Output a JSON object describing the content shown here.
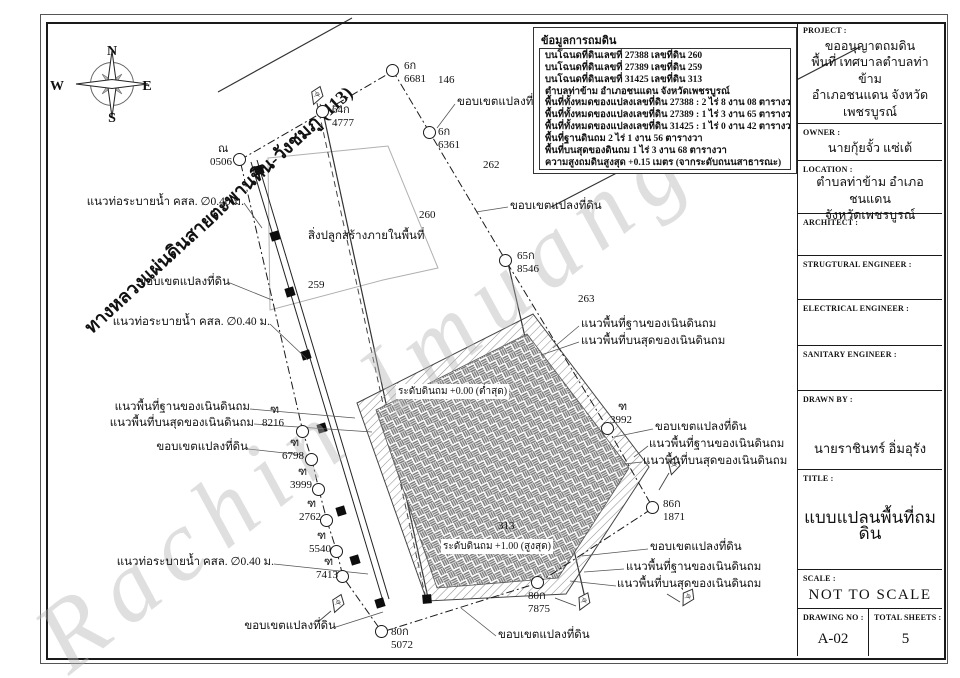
{
  "watermark": "Rachin Imuang",
  "compass": {
    "n": "N",
    "s": "S",
    "e": "E",
    "w": "W"
  },
  "road_label": "ทางหลวงแผ่นดินสายตะพานหิน-วังชมภู (113)",
  "info_box": {
    "title": "ข้อมูลการถมดิน",
    "lines": [
      "บนโฉนดที่ดินเลขที่ 27388 เลขที่ดิน 260",
      "บนโฉนดที่ดินเลขที่ 27389 เลขที่ดิน 259",
      "บนโฉนดที่ดินเลขที่ 31425 เลขที่ดิน 313",
      "ตำบลท่าข้าม อำเภอชนแดน จังหวัดเพชรบูรณ์",
      "พื้นที่ทั้งหมดของแปลงเลขที่ดิน 27388 : 2 ไร่ 8 งาน 08 ตารางวา",
      "พื้นที่ทั้งหมดของแปลงเลขที่ดิน 27389 : 1 ไร่ 3 งาน 65 ตารางวา",
      "พื้นที่ทั้งหมดของแปลงเลขที่ดิน 31425 : 1 ไร่ 0 งาน 42 ตารางวา",
      "พื้นที่ฐานดินถม 2 ไร่ 1 งาน 56 ตารางวา",
      "พื้นที่บนสุดของดินถม 1 ไร่ 3 งาน 68 ตารางวา",
      "ความสูงถมดินสูงสุด +0.15 เมตร (จากระดับถนนสาธารณะ)"
    ]
  },
  "title_block": {
    "project": {
      "label": "PROJECT :",
      "lines": [
        "ขออนุญาตถมดิน",
        "พื้นที่ เทศบาลตำบลท่าข้าม",
        "อำเภอชนแดน จังหวัดเพชรบูรณ์"
      ]
    },
    "owner": {
      "label": "OWNER :",
      "value": "นายกุ้ยจั้ว แซ่เต้"
    },
    "location": {
      "label": "LOCATION :",
      "lines": [
        "ตำบลท่าข้าม อำเภอชนแดน",
        "จังหวัดเพชรบูรณ์"
      ]
    },
    "architect": {
      "label": "ARCHITECT :",
      "value": ""
    },
    "structural": {
      "label": "STRUGTURAL ENGINEER :",
      "value": ""
    },
    "electrical": {
      "label": "ELECTRICAL ENGINEER :",
      "value": ""
    },
    "sanitary": {
      "label": "SANITARY ENGINEER :",
      "value": ""
    },
    "drawn_by": {
      "label": "DRAWN BY :",
      "value": "นายราชินทร์ อิ่มอุรัง"
    },
    "title": {
      "label": "TITLE :",
      "value": "แบบแปลนพื้นที่ถมดิน"
    },
    "scale": {
      "label": "SCALE :",
      "value": "NOT TO SCALE"
    },
    "drawing_no": {
      "label": "DRAWING NO :",
      "value": "A-02"
    },
    "total_sheets": {
      "label": "TOTAL SHEETS :",
      "value": "5"
    }
  },
  "plan": {
    "points": [
      {
        "name": "ณ",
        "num": "0506",
        "cx": 240,
        "cy": 160,
        "lx": 210,
        "ly": 143
      },
      {
        "name": "64ก",
        "num": "4777",
        "cx": 323,
        "cy": 112,
        "lx": 332,
        "ly": 104
      },
      {
        "name": "6ก",
        "num": "6681",
        "cx": 393,
        "cy": 71,
        "lx": 404,
        "ly": 60
      },
      {
        "name": "6ก",
        "num": "6361",
        "cx": 430,
        "cy": 133,
        "lx": 438,
        "ly": 126
      },
      {
        "name": "65ก",
        "num": "8546",
        "cx": 506,
        "cy": 261,
        "lx": 517,
        "ly": 250
      },
      {
        "name": "ฑ",
        "num": "3992",
        "cx": 608,
        "cy": 429,
        "lx": 610,
        "ly": 401
      },
      {
        "name": "86ก",
        "num": "1871",
        "cx": 653,
        "cy": 508,
        "lx": 663,
        "ly": 498
      },
      {
        "name": "80ก",
        "num": "7875",
        "cx": 538,
        "cy": 583,
        "lx": 528,
        "ly": 590
      },
      {
        "name": "80ก",
        "num": "5072",
        "cx": 382,
        "cy": 632,
        "lx": 391,
        "ly": 626
      },
      {
        "name": "ฑ",
        "num": "7413",
        "cx": 343,
        "cy": 577,
        "lx": 316,
        "ly": 556
      },
      {
        "name": "ฑ",
        "num": "5540",
        "cx": 337,
        "cy": 552,
        "lx": 309,
        "ly": 530
      },
      {
        "name": "ฑ",
        "num": "2762",
        "cx": 327,
        "cy": 521,
        "lx": 299,
        "ly": 498
      },
      {
        "name": "ฑ",
        "num": "3999",
        "cx": 319,
        "cy": 490,
        "lx": 290,
        "ly": 466
      },
      {
        "name": "ฑ",
        "num": "6798",
        "cx": 312,
        "cy": 460,
        "lx": 282,
        "ly": 437
      },
      {
        "name": "ฑ",
        "num": "8216",
        "cx": 303,
        "cy": 432,
        "lx": 262,
        "ly": 404
      }
    ],
    "annotations": [
      {
        "t": "แนวท่อระบายน้ำ คสล. ∅0.40 ม.",
        "x": 244,
        "y": 196,
        "align": "right"
      },
      {
        "t": "ขอบเขตแปลงที่ดิน",
        "x": 230,
        "y": 276,
        "align": "right"
      },
      {
        "t": "แนวท่อระบายน้ำ คสล. ∅0.40 ม.",
        "x": 270,
        "y": 316,
        "align": "right"
      },
      {
        "t": "แนวพื้นที่ฐานของเนินดินถม",
        "x": 250,
        "y": 401,
        "align": "right"
      },
      {
        "t": "แนวพื้นที่บนสุดของเนินดินถม",
        "x": 254,
        "y": 417,
        "align": "right"
      },
      {
        "t": "ขอบเขตแปลงที่ดิน",
        "x": 248,
        "y": 441,
        "align": "right"
      },
      {
        "t": "แนวท่อระบายน้ำ คสล. ∅0.40 ม.",
        "x": 274,
        "y": 556,
        "align": "right"
      },
      {
        "t": "ขอบเขตแปลงที่ดิน",
        "x": 336,
        "y": 620,
        "align": "right"
      },
      {
        "t": "ขอบเขตแปลงที่ดิน",
        "x": 457,
        "y": 96,
        "align": "left"
      },
      {
        "t": "ขอบเขตแปลงที่ดิน",
        "x": 510,
        "y": 200,
        "align": "left"
      },
      {
        "t": "แนวพื้นที่ฐานของเนินดินถม",
        "x": 581,
        "y": 318,
        "align": "left"
      },
      {
        "t": "แนวพื้นที่บนสุดของเนินดินถม",
        "x": 581,
        "y": 335,
        "align": "left"
      },
      {
        "t": "ขอบเขตแปลงที่ดิน",
        "x": 655,
        "y": 421,
        "align": "left"
      },
      {
        "t": "แนวพื้นที่ฐานของเนินดินถม",
        "x": 649,
        "y": 438,
        "align": "left"
      },
      {
        "t": "แนวพื้นที่บนสุดของเนินดินถม",
        "x": 643,
        "y": 455,
        "align": "left"
      },
      {
        "t": "ขอบเขตแปลงที่ดิน",
        "x": 650,
        "y": 541,
        "align": "left"
      },
      {
        "t": "แนวพื้นที่ฐานของเนินดินถม",
        "x": 626,
        "y": 561,
        "align": "left"
      },
      {
        "t": "แนวพื้นที่บนสุดของเนินดินถม",
        "x": 617,
        "y": 578,
        "align": "left"
      },
      {
        "t": "ขอบเขตแปลงที่ดิน",
        "x": 498,
        "y": 629,
        "align": "left"
      },
      {
        "t": "สิ่งปลูกสร้างภายในพื้นที่",
        "x": 308,
        "y": 230,
        "align": "left"
      }
    ],
    "parcel_numbers": [
      {
        "n": "146",
        "x": 438,
        "y": 74
      },
      {
        "n": "262",
        "x": 483,
        "y": 159
      },
      {
        "n": "260",
        "x": 419,
        "y": 209
      },
      {
        "n": "259",
        "x": 308,
        "y": 279
      },
      {
        "n": "263",
        "x": 578,
        "y": 293
      },
      {
        "n": "313",
        "x": 498,
        "y": 520
      }
    ],
    "level_labels": [
      {
        "t": "ระดับดินถม +0.00 (ต่ำสุด)",
        "x": 396,
        "y": 384
      },
      {
        "t": "ระดับดินถม +1.00 (สูงสุด)",
        "x": 441,
        "y": 539
      }
    ]
  }
}
